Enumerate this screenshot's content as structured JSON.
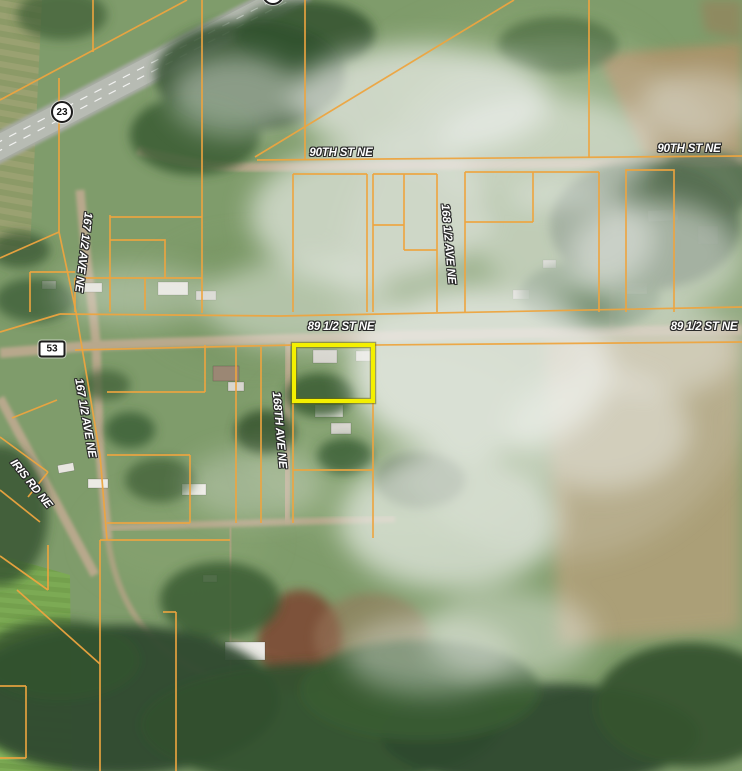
{
  "map": {
    "description": "Satellite parcel map viewer",
    "colors": {
      "parcel_line": "#EDA43F",
      "highlight": "#F4F000",
      "label_text": "#FFFFFF",
      "label_outline": "#2A2A2A"
    },
    "road_labels": [
      {
        "id": "90th-st-ne-west",
        "text": "90TH ST NE",
        "x": 341,
        "y": 153,
        "rotation": 0
      },
      {
        "id": "90th-st-ne-east",
        "text": "90TH ST NE",
        "x": 689,
        "y": 149,
        "rotation": 0
      },
      {
        "id": "89-half-st-ne-west",
        "text": "89 1/2 ST NE",
        "x": 341,
        "y": 327,
        "rotation": 0
      },
      {
        "id": "89-half-st-ne-east",
        "text": "89 1/2 ST NE",
        "x": 704,
        "y": 327,
        "rotation": 0
      },
      {
        "id": "167-half-ave-ne-north",
        "text": "167 1/2 AVE NE",
        "x": 83,
        "y": 252,
        "rotation": 97
      },
      {
        "id": "167-half-ave-ne-south",
        "text": "167 1/2 AVE NE",
        "x": 85,
        "y": 418,
        "rotation": 80
      },
      {
        "id": "168-half-ave-ne",
        "text": "168 1/2 AVE NE",
        "x": 448,
        "y": 244,
        "rotation": 85
      },
      {
        "id": "168th-ave-ne",
        "text": "168TH AVE NE",
        "x": 279,
        "y": 430,
        "rotation": 85
      },
      {
        "id": "iris-rd-ne",
        "text": "IRIS RD NE",
        "x": 31,
        "y": 484,
        "rotation": 51
      }
    ],
    "highway_shields": [
      {
        "id": "23",
        "text": "23",
        "shape": "circle",
        "x": 62,
        "y": 112
      },
      {
        "id": "23-top",
        "text": "",
        "shape": "circle",
        "x": 273,
        "y": -6
      },
      {
        "id": "53",
        "text": "53",
        "shape": "rect",
        "x": 52,
        "y": 349
      }
    ],
    "highlight_parcel": {
      "x": 294,
      "y": 345,
      "width": 79,
      "height": 56
    }
  }
}
